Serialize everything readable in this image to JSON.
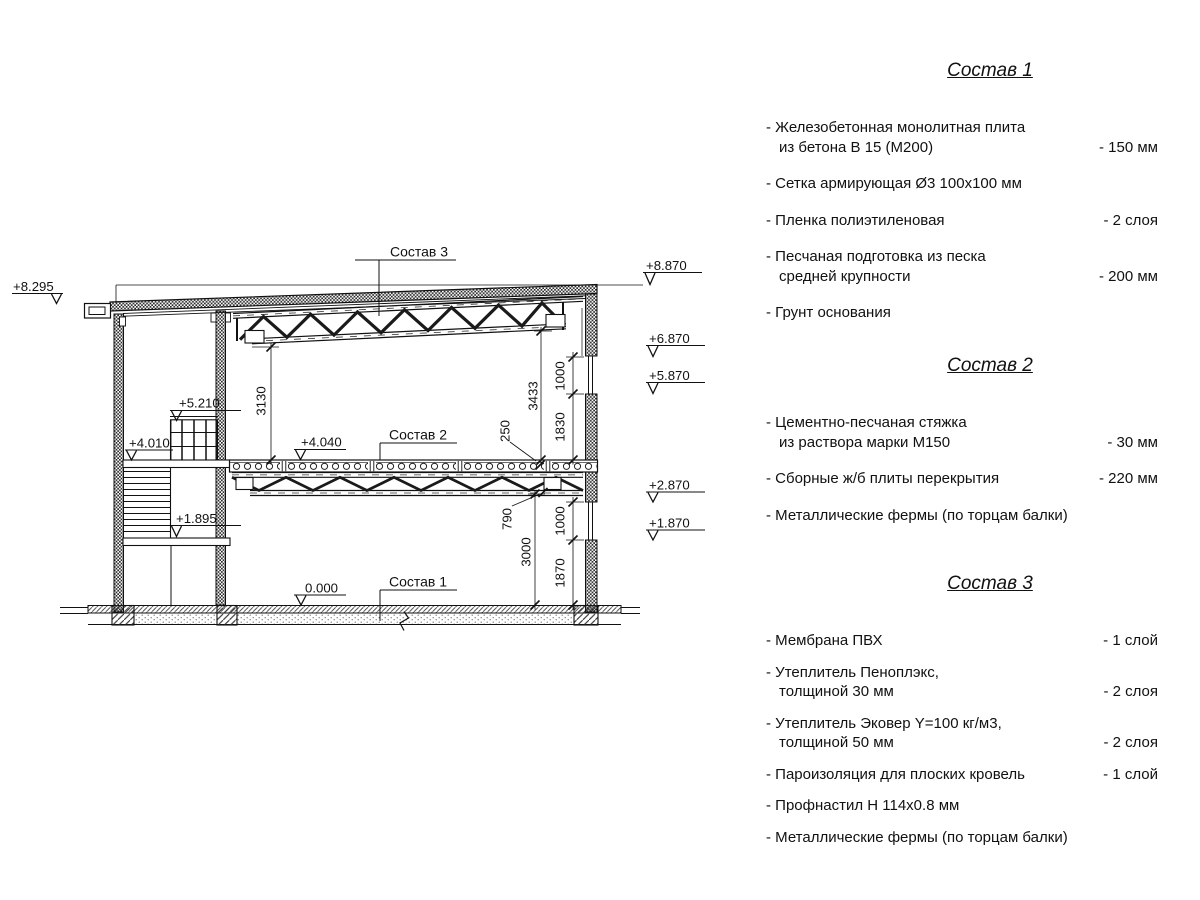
{
  "drawing": {
    "elevation_marks": {
      "eave_left": "+8.295",
      "roof_right": "+8.870",
      "win1_top": "+6.870",
      "win1_bottom": "+5.870",
      "railing_top": "+5.210",
      "landing_upper": "+4.010",
      "slab_main": "+4.040",
      "win2_top": "+2.870",
      "landing_mid": "+1.895",
      "win2_bottom": "+1.870",
      "ground": "0.000"
    },
    "dimensions": {
      "hall_height_left": "3130",
      "hall_height_right": "3433",
      "floor_package": "250",
      "win1_height": "1000",
      "win1_sill": "1830",
      "truss_depth": "790",
      "lower_height": "3000",
      "win2_height": "1000",
      "win2_sill": "1870"
    },
    "callouts": {
      "sostav1": "Состав 1",
      "sostav2": "Состав 2",
      "sostav3": "Состав 3"
    }
  },
  "specs": {
    "sections": [
      {
        "title": "Состав 1",
        "items": [
          {
            "text": "- Железобетонная  монолитная плита\nиз бетона В 15 (М200)",
            "value": "- 150 мм"
          },
          {
            "text": "- Сетка армирующая Ø3 100х100 мм",
            "value": ""
          },
          {
            "text": "- Пленка полиэтиленовая",
            "value": "-  2 слоя"
          },
          {
            "text": "- Песчаная подготовка из песка\nсредней крупности",
            "value": "- 200 мм"
          },
          {
            "text": "- Грунт основания",
            "value": ""
          }
        ]
      },
      {
        "title": "Состав 2",
        "items": [
          {
            "text": "- Цементно-песчаная стяжка\nиз раствора марки М150",
            "value": "- 30 мм"
          },
          {
            "text": "- Сборные ж/б плиты перекрытия",
            "value": "- 220 мм"
          },
          {
            "text": "- Металлические фермы (по торцам балки)",
            "value": ""
          }
        ]
      },
      {
        "title": "Состав 3",
        "items": [
          {
            "text": "- Мембрана ПВХ",
            "value": "- 1 слой"
          },
          {
            "text": "- Утеплитель Пеноплэкс,\nтолщиной 30 мм",
            "value": "- 2 слоя"
          },
          {
            "text": "- Утеплитель Эковер Y=100 кг/м3,\nтолщиной 50 мм",
            "value": "- 2 слоя"
          },
          {
            "text": "- Пароизоляция для плоских кровель",
            "value": "- 1 слой"
          },
          {
            "text": "- Профнастил Н 114х0.8 мм",
            "value": ""
          },
          {
            "text": "- Металлические фермы (по торцам балки)",
            "value": ""
          }
        ]
      }
    ]
  }
}
